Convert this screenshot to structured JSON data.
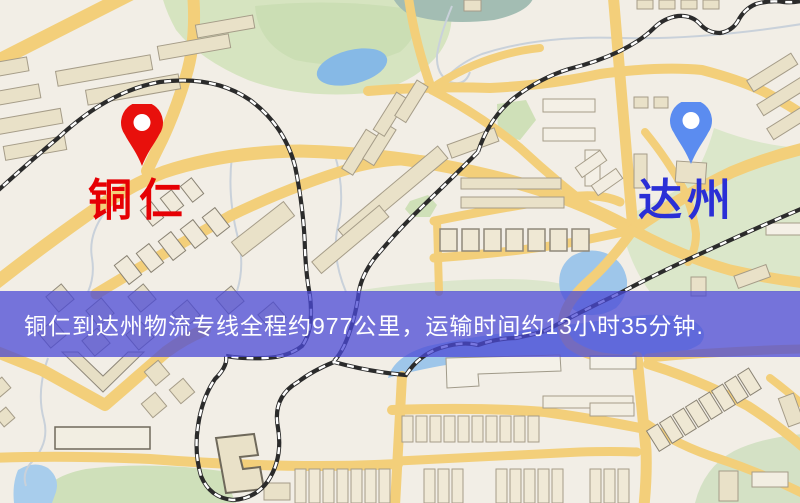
{
  "route_banner": {
    "text": "铜仁到达州物流专线全程约977公里，运输时间约13小时35分钟."
  },
  "origin": {
    "name": "铜仁",
    "marker_color": "#e8100c",
    "label_color": "#e60004"
  },
  "destination": {
    "name": "达州",
    "marker_color": "#5b8cf0",
    "label_color": "#2a2fd6"
  },
  "map": {
    "background_color": "#f2eee6",
    "road_color": "#f3cf7a",
    "park_color": "#d6e4c0",
    "water_color": "#9ec6ea",
    "railway_color": "#2b2b2b",
    "building_color": "#e9e1c8",
    "banner_background": "rgba(75,74,214,0.75)",
    "banner_text_color": "#ffffff"
  }
}
